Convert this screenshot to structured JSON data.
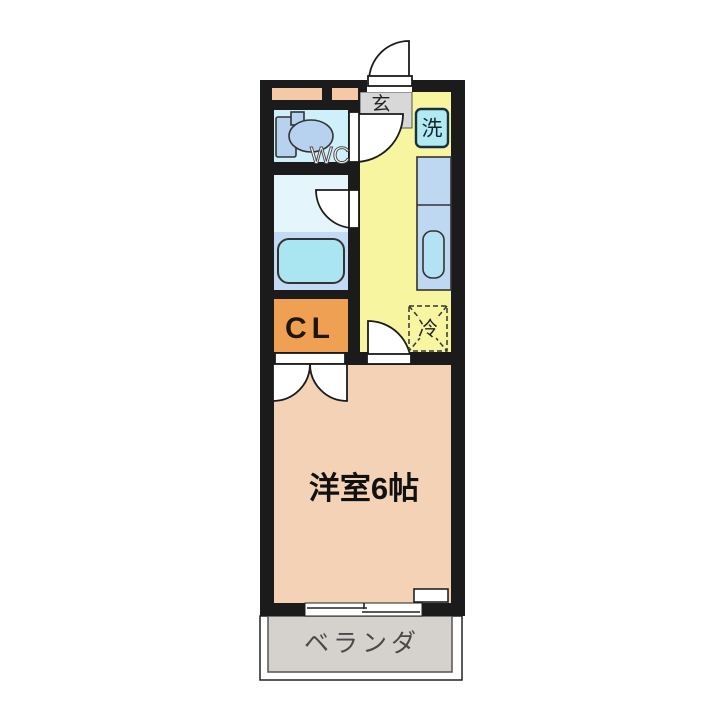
{
  "floorplan": {
    "labels": {
      "entrance": "玄",
      "washer": "洗",
      "toilet": "WC",
      "closet": "CL",
      "fridge": "冷",
      "main_room": "洋室6帖",
      "veranda": "ベランダ"
    },
    "colors": {
      "wall": "#1b1b1b",
      "hallway_floor": "#f7f5a0",
      "entrance_floor": "#d8d8d8",
      "toilet_floor": "#cfeffb",
      "bath_floor": "#e4f6fb",
      "tub_area": "#c2daf3",
      "tub": "#a9e6f2",
      "fixture_blue": "#b7d2ee",
      "counter": "#bed8f2",
      "sink": "#b3e2f4",
      "washer_box": "#b2e9f3",
      "closet_fill": "#f0a052",
      "main_room_floor": "#f3d2b5",
      "veranda_floor": "#d5d1cd",
      "wall_accent": "#f4c9a6"
    }
  }
}
